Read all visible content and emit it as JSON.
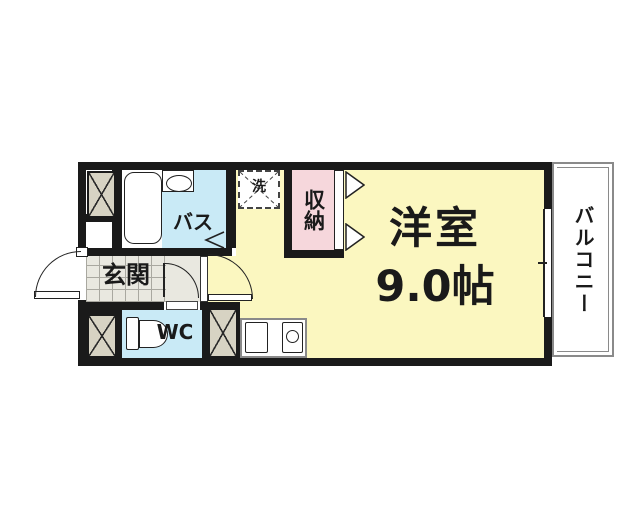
{
  "floorplan": {
    "rooms": {
      "balcony": {
        "label": "バルコニー"
      },
      "main_room": {
        "label": "洋室",
        "size": "9.0帖"
      },
      "closet": {
        "label": "収納"
      },
      "bath": {
        "label": "バス"
      },
      "laundry": {
        "label": "洗"
      },
      "entrance": {
        "label": "玄関"
      },
      "toilet": {
        "label": "WC"
      }
    },
    "colors": {
      "main_room_yellow": "#FBF7C0",
      "wet_area_cyan": "#C9EAF6",
      "closet_pink": "#F6D7DC",
      "column_tan": "#D7D3C3",
      "entrance_gray": "#E9E8E0",
      "wall_black": "#1A1A1A",
      "balcony_rail_gray": "#8A8A8A"
    }
  }
}
